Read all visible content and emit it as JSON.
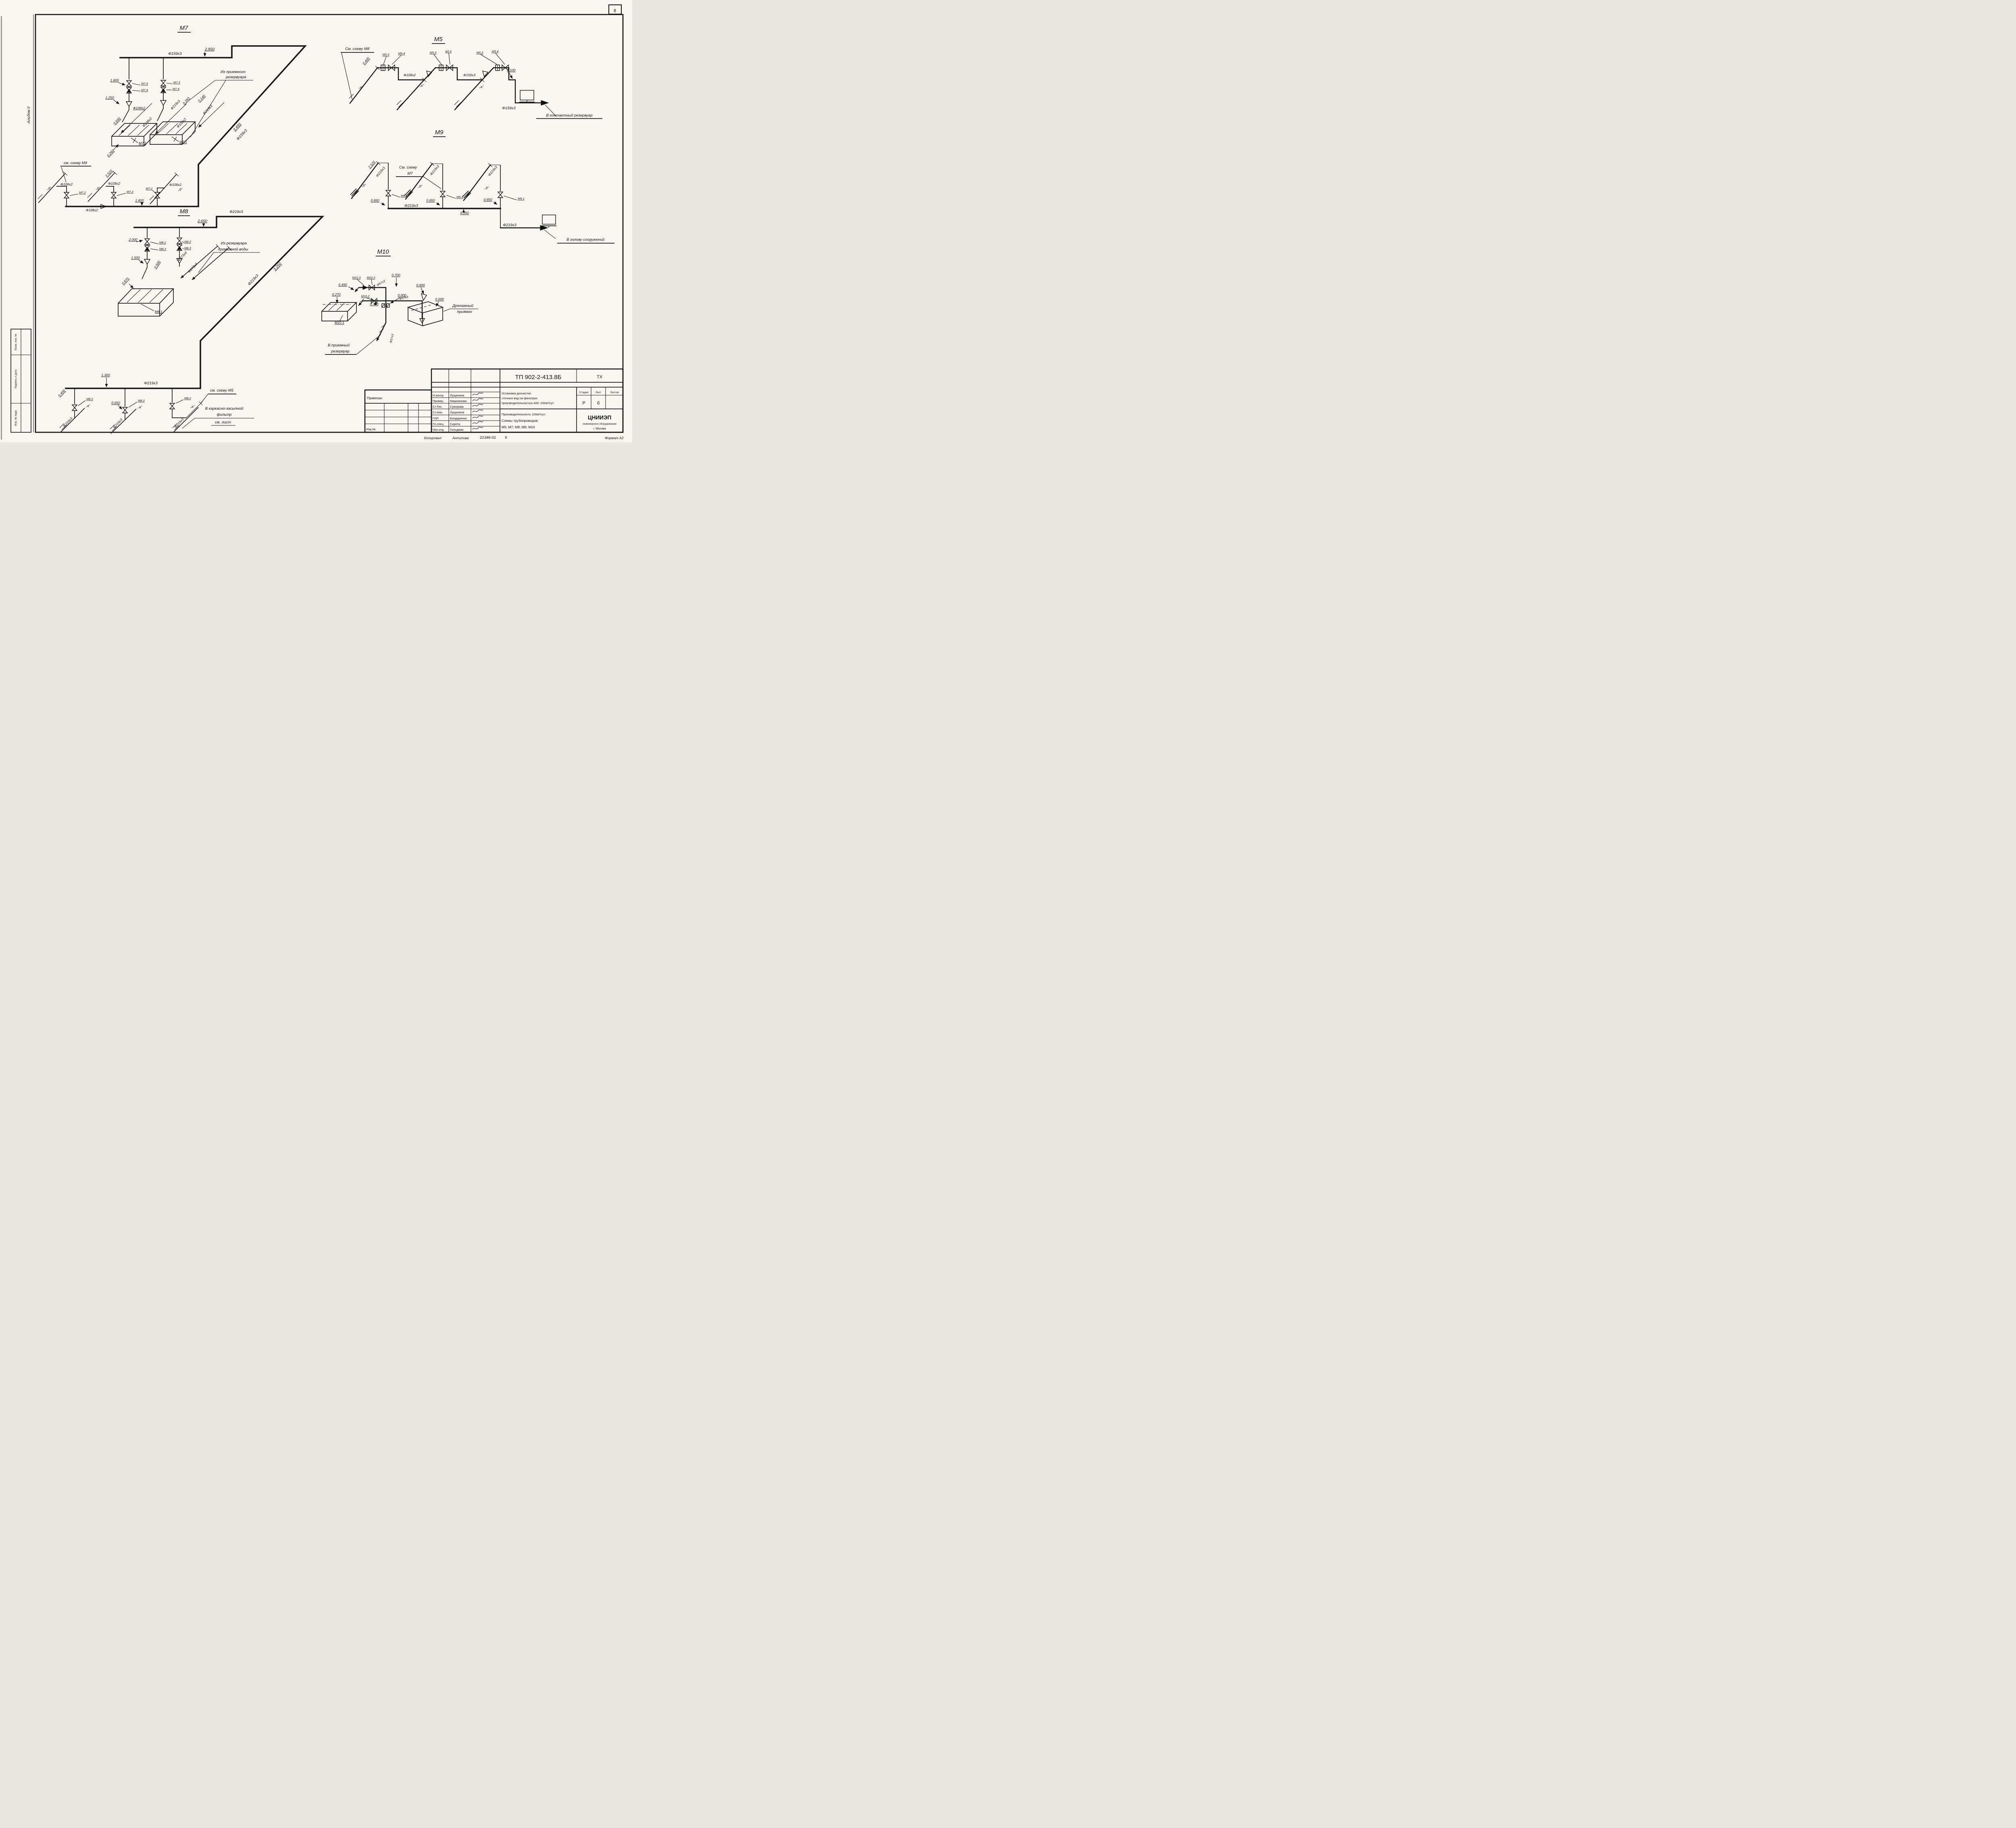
{
  "sheet": {
    "corner_number": "8",
    "album_side": "Альбом II",
    "margin_labels": [
      "Взам. инв. №",
      "Подпись и дата",
      "Инв. № подл."
    ],
    "footer": {
      "copied_label": "Копировал:",
      "copied_by": "Антипова",
      "doc_code": "21346-01",
      "sheet_no": "9",
      "format_label": "Формат А2"
    }
  },
  "m7": {
    "title": "М7",
    "dn_main": "Ф159х3",
    "dim_2850": "2.850",
    "note_intake_1": "Из приемного",
    "note_intake_2": "резервуара",
    "dim_1600": "1.600",
    "v73a": "М7.3",
    "v74a": "М7.4",
    "v73b": "М7.3",
    "v74b": "М7.4",
    "dim_1250": "1.250",
    "dn108_a": "Ф108х2",
    "dn219_a": "Ф219х3",
    "dim_0260a": "0.260",
    "dim_0140": "0.140",
    "dn219_b": "Ф219х3",
    "dn108_b": "Ф108х2",
    "dn108_c": "Ф108х2",
    "dim_0650": "0.650",
    "tank_a": "М7.1",
    "tank_b": "М7.1",
    "dim_0260b": "0.260",
    "dim_3450": "3.450",
    "dn159_diag": "Ф159х3",
    "note_see_m9": "см. схему М9",
    "dim_2520": "2.520",
    "stub_b1": "„б”",
    "stub_b2": "„б”",
    "stub_b3": "„б”",
    "dn108_s1": "Ф108х2",
    "dn108_s2": "Ф108х2",
    "dn108_s3": "Ф108х2",
    "v72a": "М7.2",
    "v72b": "М7.2",
    "v72c": "М7.2",
    "dim_1600b": "1.600",
    "dn108_man": "Ф108х2"
  },
  "m8": {
    "title": "М8",
    "dn219_top": "Ф219х3",
    "dim_2650": "2.650",
    "dim_2000": "2.000",
    "v82a": "М8.2",
    "v83a": "М8.3",
    "v82b": "М8.2",
    "v83b": "М8.3",
    "note_wash_1": "Из резервуара",
    "note_wash_2": "промывной воды",
    "dim_1500": "1.500",
    "dim_0500": "0.500",
    "dn273_a": "Ф273х4",
    "dn273_b": "Ф273х4",
    "dim_0870": "0.870",
    "tank": "М8.1",
    "dn219_diag": "Ф219х3",
    "dim_3250": "3.250",
    "dim_1300": "1.300",
    "dn219_man": "Ф219х3",
    "v82c": "М8.2",
    "dim_0650": "0.650",
    "v82d": "М8.2",
    "v82e": "М8.2",
    "dim_0400": "0.400",
    "stub_a1": "„а”",
    "stub_a2": "„а”",
    "stub_a3": "„а”",
    "dn219_s1": "Ф219х3",
    "dn219_s2": "Ф219х3",
    "dn219_s3": "Ф219х3",
    "note_see_m5": "см. схему М5",
    "note_filter_1": "В каркасно-засыпной",
    "note_filter_2": "фильтр",
    "note_filter_3": "см. лист"
  },
  "m5": {
    "title": "М5",
    "note_see_m8": "См. схему М8",
    "dim_0400": "0.400",
    "v53a": "М5.3",
    "v54a": "М5.4",
    "v53b": "М5.3",
    "v54b": "м5.4",
    "v53c": "М5.3",
    "v54c": "М5.4",
    "dn108": "Ф108х2",
    "dn159_a": "Ф159х3",
    "dim_0100": "0.100",
    "stub_a1": "„а”",
    "stub_a2": "„а”",
    "stub_a3": "„а”",
    "dn159_b": "Ф159х3",
    "note_out": "В контактный резервуар"
  },
  "m9": {
    "title": "М9",
    "dim_2520": "2.520",
    "dn219_s1": "Ф219х3",
    "dn219_s2": "Ф219х3",
    "dn219_s3": "Ф219х3",
    "note_see_m7_1": "См. схему",
    "note_see_m7_2": "М7",
    "stub_b1": "„б”",
    "stub_b2": "„б”",
    "stub_b3": "„б”",
    "v1": "М9.1",
    "v2": "М9.1",
    "v3": "М9.1",
    "dim_0650a": "0.650",
    "dim_0650b": "0.650",
    "dim_0650c": "0.650",
    "dn219_man": "Ф219х3",
    "dim_0150": "0.150",
    "dn219_out": "Ф219х3",
    "note_out": "В голову сооружений"
  },
  "m10": {
    "title": "М10",
    "v103": "М10.3",
    "v102a": "М10.2",
    "dim_0700": "0.700",
    "dn57a": "Ф57х3",
    "dim_0490": "0.490",
    "v102b": "М10.2",
    "dn57b": "Ф57х3",
    "dim_0600": "0.600",
    "dim_0270": "0.270",
    "dim_0380": "0.380",
    "dim_0000a": "0.000",
    "dim_0000b": "0.000",
    "note_pit_1": "Дренажный",
    "note_pit_2": "приямок",
    "tank": "М10.1",
    "note_out_1": "В приемный",
    "note_out_2": "резервуар",
    "dn57c": "Ф57х3"
  },
  "titleblock": {
    "doc_number": "ТП 902-2-413.8Б",
    "doc_type": "ТХ",
    "binding_label": "Привязан",
    "inv_label": "Инв.№",
    "roles": [
      {
        "role": "Н.контр.",
        "name": "Лущихина"
      },
      {
        "role": "Провер.",
        "name": "Машнинова"
      },
      {
        "role": "Ст.Тех.",
        "name": "Суворова"
      },
      {
        "role": "Ст.инж.",
        "name": "Лущихина"
      },
      {
        "role": "ГИП",
        "name": "Бондаренко"
      },
      {
        "role": "Гл.спец.",
        "name": "Сирота"
      },
      {
        "role": "Нач.отд.",
        "name": "Гольдман"
      }
    ],
    "project_1": "Установка доочистки",
    "project_2": "сточных вод на фильтрах",
    "project_3": "производительностью 400; 100м³/сут.",
    "stage_label": "Стадия",
    "sheet_label": "Лист",
    "sheets_label": "Листов",
    "stage": "Р",
    "sheet": "б",
    "sheets": "",
    "content_1": "Производительность 100м³/сут.",
    "content_2": "Схемы трубопроводов:",
    "content_3": "М5; М7; М8; М9; М10",
    "org": "ЦНИИЭП",
    "org_2": "инженерного оборудования",
    "org_3": "г. Москва"
  }
}
